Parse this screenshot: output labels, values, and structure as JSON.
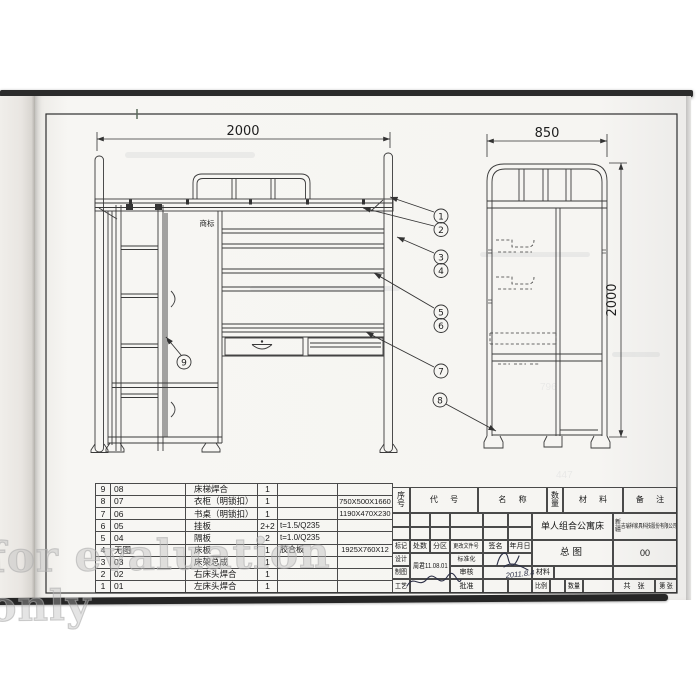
{
  "watermark": "for evaluation only",
  "dims": {
    "front_width": "2000",
    "end_width": "850",
    "end_height": "2000"
  },
  "front_view": {
    "trademark_label": "商标"
  },
  "balloons": [
    "1",
    "2",
    "3",
    "4",
    "5",
    "6",
    "7",
    "8",
    "9"
  ],
  "parts_table": {
    "rows": [
      {
        "seq": "9",
        "code": "08",
        "name": "床梯焊合",
        "qty": "1",
        "material": "",
        "spec": ""
      },
      {
        "seq": "8",
        "code": "07",
        "name": "衣柜（明锁扣）",
        "qty": "1",
        "material": "",
        "spec": "750X500X1660"
      },
      {
        "seq": "7",
        "code": "06",
        "name": "书桌（明锁扣）",
        "qty": "1",
        "material": "",
        "spec": "1190X470X230"
      },
      {
        "seq": "6",
        "code": "05",
        "name": "挂板",
        "qty": "2+2",
        "material": "t=1.5/Q235",
        "spec": ""
      },
      {
        "seq": "5",
        "code": "04",
        "name": "隔板",
        "qty": "2",
        "material": "t=1.0/Q235",
        "spec": ""
      },
      {
        "seq": "4",
        "code": "无图",
        "name": "床板",
        "qty": "1",
        "material": "胶合板",
        "spec": "1925X760X12"
      },
      {
        "seq": "3",
        "code": "03",
        "name": "床架总成",
        "qty": "1",
        "material": "",
        "spec": ""
      },
      {
        "seq": "2",
        "code": "02",
        "name": "右床头焊合",
        "qty": "1",
        "material": "",
        "spec": ""
      },
      {
        "seq": "1",
        "code": "01",
        "name": "左床头焊合",
        "qty": "1",
        "material": "",
        "spec": ""
      }
    ]
  },
  "title_block": {
    "headers": {
      "seq": "序号",
      "code": "代 号",
      "name": "名 称",
      "qty": "数量",
      "material": "材 料",
      "notes": "备 注"
    },
    "product_name": "单人组合公寓床",
    "company_region": "新疆",
    "company_name": "吉瑞祥家具科技股份有限公司",
    "drawing_title": "总图",
    "drawing_no": "00",
    "designer_date": "周君11.08.01",
    "audit_date": "2011.8.4",
    "labels": {
      "mark": "标记",
      "count": "处数",
      "zone": "分区",
      "change_doc": "更改文件号",
      "sign": "签名",
      "date": "年月日",
      "design": "设计",
      "draft": "制图",
      "craft": "工艺",
      "standardize": "标准化",
      "audit": "审核",
      "approve": "批准",
      "material": "材料",
      "scale": "比例",
      "quantity": "数量",
      "sheets_total": "共　张",
      "sheet_no": "第 张"
    }
  },
  "ghost_texts": {
    "a": "796",
    "b": "447"
  }
}
